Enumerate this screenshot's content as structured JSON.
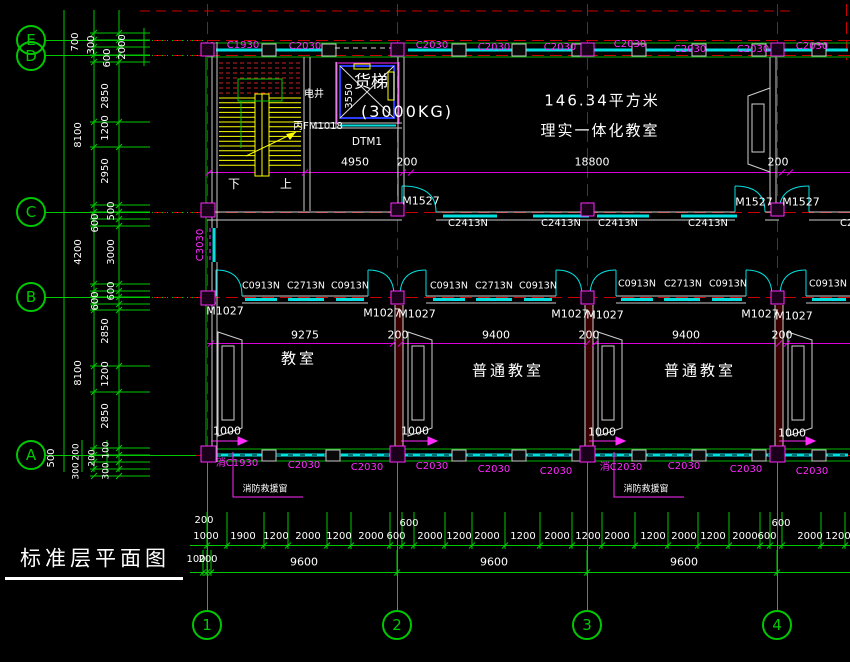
{
  "colors": {
    "white": "#ffffff",
    "magenta": "#ff2aff",
    "green": "#00c800",
    "cyan": "#00e0e0",
    "red": "#c80000",
    "yellow": "#ffff00",
    "blue": "#2b3cff",
    "gray": "#c8c8c8"
  },
  "title": {
    "text": "标准层平面图"
  },
  "grid": {
    "rows": [
      {
        "label": "E"
      },
      {
        "label": "D"
      },
      {
        "label": "C"
      },
      {
        "label": "B"
      },
      {
        "label": "A"
      }
    ],
    "cols": [
      {
        "label": "1"
      },
      {
        "label": "2"
      },
      {
        "label": "3"
      },
      {
        "label": "4"
      }
    ]
  },
  "rooms": {
    "big_classroom": {
      "area": "146.34平方米",
      "name": "理实一体化教室"
    },
    "classroom1": "教室",
    "classroom2": "普通教室",
    "classroom3": "普通教室",
    "elevator": {
      "label": "货梯",
      "capacity": "(3000KG)",
      "code": "DTM1"
    },
    "shaft": {
      "label": "电井",
      "door": "丙FM1018"
    },
    "stair": {
      "down": "下",
      "up": "上"
    }
  },
  "notes": {
    "fire_window": "消防救援窗"
  },
  "label_groups": {
    "top_windows": [
      {
        "t": "C1930",
        "x": 243,
        "y": 46,
        "c": "magenta",
        "s": 10
      },
      {
        "t": "C2030",
        "x": 305,
        "y": 47,
        "c": "magenta",
        "s": 10
      },
      {
        "t": "C2030",
        "x": 432,
        "y": 46,
        "c": "magenta",
        "s": 10
      },
      {
        "t": "C2030",
        "x": 494,
        "y": 48,
        "c": "magenta",
        "s": 10
      },
      {
        "t": "C2030",
        "x": 560,
        "y": 48,
        "c": "magenta",
        "s": 10
      },
      {
        "t": "C2030",
        "x": 630,
        "y": 45,
        "c": "magenta",
        "s": 10
      },
      {
        "t": "C2030",
        "x": 690,
        "y": 50,
        "c": "magenta",
        "s": 10
      },
      {
        "t": "C2030",
        "x": 753,
        "y": 50,
        "c": "magenta",
        "s": 10
      },
      {
        "t": "C2030",
        "x": 812,
        "y": 47,
        "c": "magenta",
        "s": 10
      }
    ],
    "row_c_doors": [
      {
        "t": "M1527",
        "x": 421,
        "y": 201,
        "c": "white",
        "s": 11
      },
      {
        "t": "M1527",
        "x": 754,
        "y": 202,
        "c": "white",
        "s": 11
      },
      {
        "t": "M1527",
        "x": 801,
        "y": 202,
        "c": "white",
        "s": 11
      }
    ],
    "row_c_windows": [
      {
        "t": "C2413N",
        "x": 468,
        "y": 224,
        "c": "white",
        "s": 10
      },
      {
        "t": "C2413N",
        "x": 561,
        "y": 224,
        "c": "white",
        "s": 10
      },
      {
        "t": "C2413N",
        "x": 618,
        "y": 224,
        "c": "white",
        "s": 10
      },
      {
        "t": "C2413N",
        "x": 708,
        "y": 224,
        "c": "white",
        "s": 10
      },
      {
        "t": "C2413N",
        "x": 860,
        "y": 224,
        "c": "white",
        "s": 10
      }
    ],
    "row_b_windows": [
      {
        "t": "C0913N",
        "x": 261,
        "y": 286,
        "c": "white",
        "s": 9.5
      },
      {
        "t": "C2713N",
        "x": 306,
        "y": 286,
        "c": "white",
        "s": 9.5
      },
      {
        "t": "C0913N",
        "x": 350,
        "y": 286,
        "c": "white",
        "s": 9.5
      },
      {
        "t": "C0913N",
        "x": 449,
        "y": 286,
        "c": "white",
        "s": 9.5
      },
      {
        "t": "C2713N",
        "x": 494,
        "y": 286,
        "c": "white",
        "s": 9.5
      },
      {
        "t": "C0913N",
        "x": 538,
        "y": 286,
        "c": "white",
        "s": 9.5
      },
      {
        "t": "C0913N",
        "x": 637,
        "y": 284,
        "c": "white",
        "s": 9.5
      },
      {
        "t": "C2713N",
        "x": 683,
        "y": 284,
        "c": "white",
        "s": 9.5
      },
      {
        "t": "C0913N",
        "x": 728,
        "y": 284,
        "c": "white",
        "s": 9.5
      },
      {
        "t": "C0913N",
        "x": 828,
        "y": 284,
        "c": "white",
        "s": 9.5
      }
    ],
    "row_b_doors": [
      {
        "t": "M1027",
        "x": 225,
        "y": 311,
        "c": "white",
        "s": 11
      },
      {
        "t": "M1027",
        "x": 382,
        "y": 313,
        "c": "white",
        "s": 11
      },
      {
        "t": "M1027",
        "x": 417,
        "y": 314,
        "c": "white",
        "s": 11
      },
      {
        "t": "M1027",
        "x": 570,
        "y": 314,
        "c": "white",
        "s": 11
      },
      {
        "t": "M1027",
        "x": 605,
        "y": 315,
        "c": "white",
        "s": 11
      },
      {
        "t": "M1027",
        "x": 760,
        "y": 314,
        "c": "white",
        "s": 11
      },
      {
        "t": "M1027",
        "x": 794,
        "y": 316,
        "c": "white",
        "s": 11
      }
    ],
    "bottom_windows": [
      {
        "t": "消C1930",
        "x": 237,
        "y": 464,
        "c": "magenta",
        "s": 10
      },
      {
        "t": "C2030",
        "x": 304,
        "y": 466,
        "c": "magenta",
        "s": 10
      },
      {
        "t": "C2030",
        "x": 367,
        "y": 468,
        "c": "magenta",
        "s": 10
      },
      {
        "t": "C2030",
        "x": 432,
        "y": 467,
        "c": "magenta",
        "s": 10
      },
      {
        "t": "C2030",
        "x": 494,
        "y": 470,
        "c": "magenta",
        "s": 10
      },
      {
        "t": "C2030",
        "x": 556,
        "y": 472,
        "c": "magenta",
        "s": 10
      },
      {
        "t": "消C2030",
        "x": 621,
        "y": 468,
        "c": "magenta",
        "s": 10
      },
      {
        "t": "C2030",
        "x": 684,
        "y": 467,
        "c": "magenta",
        "s": 10
      },
      {
        "t": "C2030",
        "x": 746,
        "y": 470,
        "c": "magenta",
        "s": 10
      },
      {
        "t": "C2030",
        "x": 812,
        "y": 472,
        "c": "magenta",
        "s": 10
      }
    ],
    "mid_dims": [
      {
        "t": "4950",
        "x": 355,
        "y": 162,
        "c": "white",
        "s": 11
      },
      {
        "t": "200",
        "x": 407,
        "y": 162,
        "c": "white",
        "s": 11
      },
      {
        "t": "18800",
        "x": 592,
        "y": 162,
        "c": "white",
        "s": 11
      },
      {
        "t": "200",
        "x": 778,
        "y": 162,
        "c": "white",
        "s": 11
      }
    ],
    "room_dims": [
      {
        "t": "9275",
        "x": 305,
        "y": 335,
        "c": "white",
        "s": 11
      },
      {
        "t": "200",
        "x": 398,
        "y": 335,
        "c": "white",
        "s": 11
      },
      {
        "t": "9400",
        "x": 496,
        "y": 335,
        "c": "white",
        "s": 11
      },
      {
        "t": "200",
        "x": 589,
        "y": 335,
        "c": "white",
        "s": 11
      },
      {
        "t": "9400",
        "x": 686,
        "y": 335,
        "c": "white",
        "s": 11
      },
      {
        "t": "200",
        "x": 782,
        "y": 335,
        "c": "white",
        "s": 11
      }
    ],
    "door_dims": [
      {
        "t": "1000",
        "x": 227,
        "y": 431,
        "c": "white",
        "s": 11
      },
      {
        "t": "1000",
        "x": 415,
        "y": 431,
        "c": "white",
        "s": 11
      },
      {
        "t": "1000",
        "x": 602,
        "y": 432,
        "c": "white",
        "s": 11
      },
      {
        "t": "1000",
        "x": 792,
        "y": 433,
        "c": "white",
        "s": 11
      }
    ],
    "left_dims": [
      {
        "t": "700",
        "x": 76,
        "y": 42,
        "c": "white",
        "s": 10,
        "r": -90
      },
      {
        "t": "300",
        "x": 92,
        "y": 45,
        "c": "white",
        "s": 10,
        "r": -90
      },
      {
        "t": "600",
        "x": 108,
        "y": 58,
        "c": "white",
        "s": 10,
        "r": -90
      },
      {
        "t": "2000",
        "x": 123,
        "y": 47,
        "c": "white",
        "s": 10,
        "r": -90
      },
      {
        "t": "2850",
        "x": 106,
        "y": 96,
        "c": "white",
        "s": 10,
        "r": -90
      },
      {
        "t": "1200",
        "x": 106,
        "y": 128,
        "c": "white",
        "s": 10,
        "r": -90
      },
      {
        "t": "2950",
        "x": 106,
        "y": 171,
        "c": "white",
        "s": 10,
        "r": -90
      },
      {
        "t": "8100",
        "x": 79,
        "y": 135,
        "c": "white",
        "s": 10,
        "r": -90
      },
      {
        "t": "600",
        "x": 96,
        "y": 223,
        "c": "white",
        "s": 10,
        "r": -90
      },
      {
        "t": "500",
        "x": 112,
        "y": 211,
        "c": "white",
        "s": 10,
        "r": -90
      },
      {
        "t": "4200",
        "x": 79,
        "y": 252,
        "c": "white",
        "s": 10,
        "r": -90
      },
      {
        "t": "3000",
        "x": 112,
        "y": 252,
        "c": "white",
        "s": 10,
        "r": -90
      },
      {
        "t": "600",
        "x": 96,
        "y": 301,
        "c": "white",
        "s": 10,
        "r": -90
      },
      {
        "t": "600",
        "x": 112,
        "y": 291,
        "c": "white",
        "s": 10,
        "r": -90
      },
      {
        "t": "2850",
        "x": 106,
        "y": 331,
        "c": "white",
        "s": 10,
        "r": -90
      },
      {
        "t": "8100",
        "x": 79,
        "y": 373,
        "c": "white",
        "s": 10,
        "r": -90
      },
      {
        "t": "1200",
        "x": 106,
        "y": 374,
        "c": "white",
        "s": 10,
        "r": -90
      },
      {
        "t": "2850",
        "x": 106,
        "y": 416,
        "c": "white",
        "s": 10,
        "r": -90
      },
      {
        "t": "500",
        "x": 52,
        "y": 458,
        "c": "white",
        "s": 10,
        "r": -90
      },
      {
        "t": "200",
        "x": 77,
        "y": 452,
        "c": "white",
        "s": 9,
        "r": -90
      },
      {
        "t": "300",
        "x": 77,
        "y": 471,
        "c": "white",
        "s": 9,
        "r": -90
      },
      {
        "t": "200",
        "x": 93,
        "y": 458,
        "c": "white",
        "s": 9,
        "r": -90
      },
      {
        "t": "100",
        "x": 107,
        "y": 450,
        "c": "white",
        "s": 9,
        "r": -90
      },
      {
        "t": "300",
        "x": 107,
        "y": 471,
        "c": "white",
        "s": 9,
        "r": -90
      }
    ],
    "bottom_chain": [
      {
        "t": "200",
        "x": 204,
        "y": 521,
        "c": "white",
        "s": 10
      },
      {
        "t": "1000",
        "x": 206,
        "y": 537,
        "c": "white",
        "s": 10
      },
      {
        "t": "1900",
        "x": 243,
        "y": 537,
        "c": "white",
        "s": 10
      },
      {
        "t": "1200",
        "x": 276,
        "y": 537,
        "c": "white",
        "s": 10
      },
      {
        "t": "2000",
        "x": 308,
        "y": 537,
        "c": "white",
        "s": 10
      },
      {
        "t": "1200",
        "x": 339,
        "y": 537,
        "c": "white",
        "s": 10
      },
      {
        "t": "2000",
        "x": 371,
        "y": 537,
        "c": "white",
        "s": 10
      },
      {
        "t": "600",
        "x": 396,
        "y": 537,
        "c": "white",
        "s": 10
      },
      {
        "t": "600",
        "x": 409,
        "y": 524,
        "c": "white",
        "s": 10
      },
      {
        "t": "2000",
        "x": 430,
        "y": 537,
        "c": "white",
        "s": 10
      },
      {
        "t": "1200",
        "x": 459,
        "y": 537,
        "c": "white",
        "s": 10
      },
      {
        "t": "2000",
        "x": 487,
        "y": 537,
        "c": "white",
        "s": 10
      },
      {
        "t": "1200",
        "x": 523,
        "y": 537,
        "c": "white",
        "s": 10
      },
      {
        "t": "2000",
        "x": 557,
        "y": 537,
        "c": "white",
        "s": 10
      },
      {
        "t": "1200",
        "x": 588,
        "y": 537,
        "c": "white",
        "s": 10
      },
      {
        "t": "2000",
        "x": 617,
        "y": 537,
        "c": "white",
        "s": 10
      },
      {
        "t": "1200",
        "x": 653,
        "y": 537,
        "c": "white",
        "s": 10
      },
      {
        "t": "2000",
        "x": 684,
        "y": 537,
        "c": "white",
        "s": 10
      },
      {
        "t": "1200",
        "x": 713,
        "y": 537,
        "c": "white",
        "s": 10
      },
      {
        "t": "2000",
        "x": 745,
        "y": 537,
        "c": "white",
        "s": 10
      },
      {
        "t": "600",
        "x": 767,
        "y": 537,
        "c": "white",
        "s": 10
      },
      {
        "t": "600",
        "x": 781,
        "y": 524,
        "c": "white",
        "s": 10
      },
      {
        "t": "2000",
        "x": 810,
        "y": 537,
        "c": "white",
        "s": 10
      },
      {
        "t": "1200",
        "x": 838,
        "y": 537,
        "c": "white",
        "s": 10
      }
    ],
    "bottom_totals": [
      {
        "t": "100",
        "x": 196,
        "y": 560,
        "c": "white",
        "s": 10
      },
      {
        "t": "200",
        "x": 208,
        "y": 560,
        "c": "white",
        "s": 10
      },
      {
        "t": "9600",
        "x": 304,
        "y": 562,
        "c": "white",
        "s": 11
      },
      {
        "t": "9600",
        "x": 494,
        "y": 562,
        "c": "white",
        "s": 11
      },
      {
        "t": "9600",
        "x": 684,
        "y": 562,
        "c": "white",
        "s": 11
      }
    ],
    "misc": [
      {
        "t": "C3030",
        "x": 201,
        "y": 245,
        "c": "magenta",
        "s": 10,
        "r": -90
      },
      {
        "t": "3550",
        "x": 350,
        "y": 96,
        "c": "white",
        "s": 10,
        "r": -90
      }
    ]
  },
  "ticks": {
    "left_ys": [
      33,
      40,
      47,
      55,
      62,
      122,
      147,
      205,
      212,
      219,
      226,
      284,
      291,
      297,
      304,
      310,
      366,
      392,
      448,
      455,
      462,
      469,
      476
    ],
    "row1_xs": [
      207,
      227,
      264,
      288,
      327,
      351,
      390,
      402,
      414,
      445,
      472,
      505,
      540,
      572,
      602,
      635,
      668,
      698,
      729,
      760,
      770,
      782,
      821,
      845
    ],
    "row2_xs": [
      203,
      207,
      211,
      397,
      587,
      777
    ],
    "mid1_xs": [
      209,
      305,
      403,
      411,
      782,
      790
    ],
    "mid2_xs": [
      211,
      393,
      401,
      587,
      595,
      779,
      787
    ]
  }
}
